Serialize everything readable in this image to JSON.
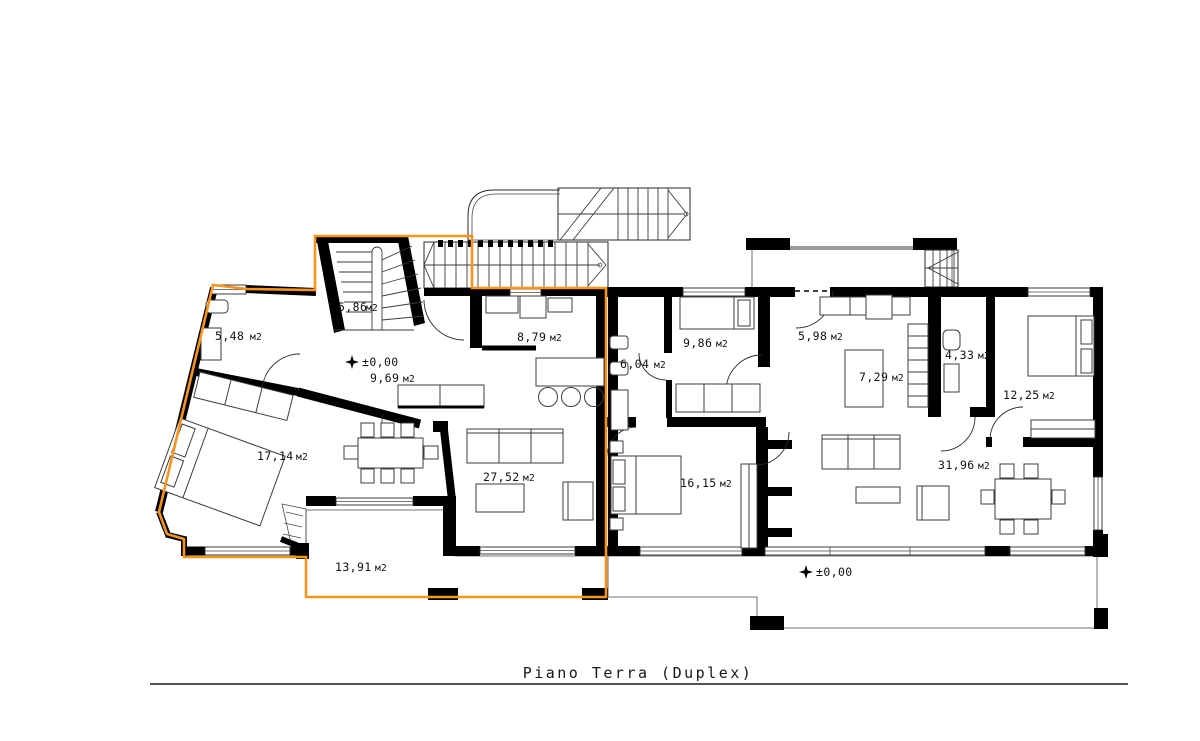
{
  "title": "Piano  Terra  (Duplex)",
  "area_unit": "м2",
  "elevation_marker": "±0,00",
  "rooms": [
    {
      "id": "stair-room",
      "area": "5,86"
    },
    {
      "id": "bath-duplex",
      "area": "5,48"
    },
    {
      "id": "bedroom-duplex",
      "area": "17,14"
    },
    {
      "id": "hall-duplex",
      "area": "9,69"
    },
    {
      "id": "kitchen-duplex",
      "area": "8,79"
    },
    {
      "id": "living-duplex",
      "area": "27,52"
    },
    {
      "id": "terrace-duplex",
      "area": "13,91"
    },
    {
      "id": "bath-2",
      "area": "6,04"
    },
    {
      "id": "bedroom-2",
      "area": "9,86"
    },
    {
      "id": "entry-2",
      "area": "5,98"
    },
    {
      "id": "kitchen-2",
      "area": "7,29"
    },
    {
      "id": "bath-3",
      "area": "4,33"
    },
    {
      "id": "bedroom-3",
      "area": "12,25"
    },
    {
      "id": "living-2",
      "area": "31,96"
    },
    {
      "id": "bedroom-4",
      "area": "16,15"
    }
  ],
  "colors": {
    "highlight": "#F7941E",
    "walls": "#000000",
    "background": "#FFFFFF"
  }
}
